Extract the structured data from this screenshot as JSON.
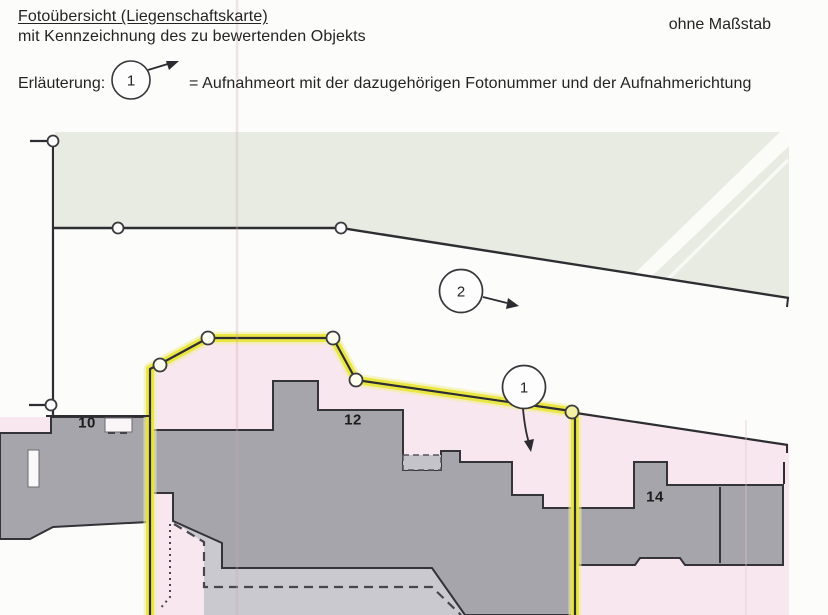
{
  "header": {
    "title": "Fotoübersicht (Liegenschaftskarte)",
    "subtitle": "mit Kennzeichnung des zu bewertenden Objekts",
    "scale_note": "ohne Maßstab"
  },
  "legend": {
    "label": "Erläuterung:",
    "symbol_number": "1",
    "description": "= Aufnahmeort mit der dazugehörigen Fotonummer und der Aufnahmerichtung"
  },
  "map": {
    "house_numbers": [
      {
        "label": "10"
      },
      {
        "label": "12"
      },
      {
        "label": "14"
      }
    ],
    "photo_markers": [
      {
        "label": "1",
        "direction": "down"
      },
      {
        "label": "2",
        "direction": "right"
      }
    ],
    "colors": {
      "field_green": "#e7ebe2",
      "parcel_pink": "#f8e7ee",
      "building_gray": "#a5a5ab",
      "terrace_gray": "#c9c9cf",
      "highlight_yellow": "#e9e63d",
      "line_black": "#2d2d32"
    }
  }
}
